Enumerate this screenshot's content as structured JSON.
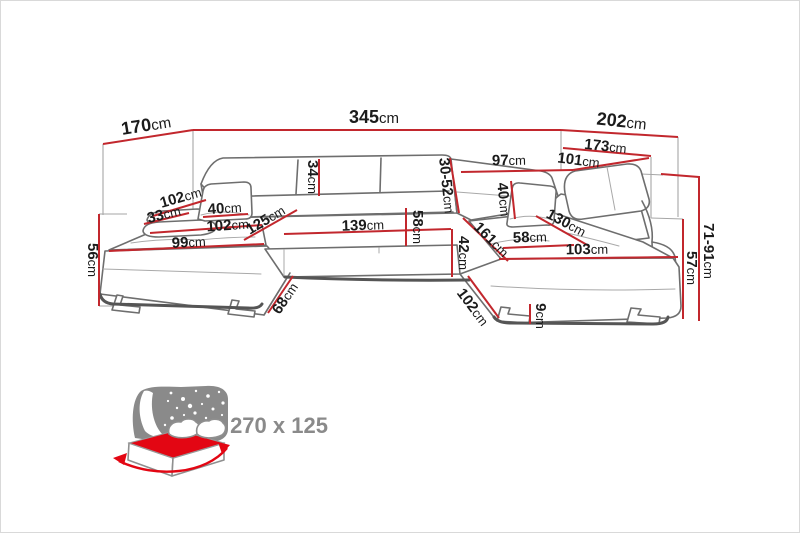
{
  "diagram": {
    "type": "sofa-dimension-drawing",
    "product": "U-shaped corner sofa with sleeping function"
  },
  "colors": {
    "dimension_red": "#c2272d",
    "icon_red": "#e30613",
    "icon_gray": "#8a8a8a",
    "outline_gray": "#6e6e6e"
  },
  "dims": {
    "w170": {
      "v": "170",
      "u": "cm"
    },
    "w345": {
      "v": "345",
      "u": "cm"
    },
    "w202": {
      "v": "202",
      "u": "cm"
    },
    "w173": {
      "v": "173",
      "u": "cm"
    },
    "w97": {
      "v": "97",
      "u": "cm"
    },
    "w101": {
      "v": "101",
      "u": "cm"
    },
    "h34": {
      "v": "34",
      "u": "cm"
    },
    "h30_52": {
      "v": "30-52",
      "u": "cm"
    },
    "d102_back": {
      "v": "102",
      "u": "cm"
    },
    "d33": {
      "v": "33",
      "u": "cm"
    },
    "w40_left": {
      "v": "40",
      "u": "cm"
    },
    "w102_left": {
      "v": "102",
      "u": "cm"
    },
    "w99": {
      "v": "99",
      "u": "cm"
    },
    "d125": {
      "v": "125",
      "u": "cm"
    },
    "w139": {
      "v": "139",
      "u": "cm"
    },
    "h58_mid": {
      "v": "58",
      "u": "cm"
    },
    "h56": {
      "v": "56",
      "u": "cm"
    },
    "d68": {
      "v": "68",
      "u": "cm"
    },
    "h42": {
      "v": "42",
      "u": "cm"
    },
    "d161": {
      "v": "161",
      "u": "cm"
    },
    "h40_right": {
      "v": "40",
      "u": "cm"
    },
    "d130": {
      "v": "130",
      "u": "cm"
    },
    "w58_right": {
      "v": "58",
      "u": "cm"
    },
    "w103": {
      "v": "103",
      "u": "cm"
    },
    "d102_right": {
      "v": "102",
      "u": "cm"
    },
    "h9": {
      "v": "9",
      "u": "cm"
    },
    "h71_91": {
      "v": "71-91",
      "u": "cm"
    },
    "h57": {
      "v": "57",
      "u": "cm"
    }
  },
  "sleeping_area": {
    "label": "270 x 125"
  }
}
